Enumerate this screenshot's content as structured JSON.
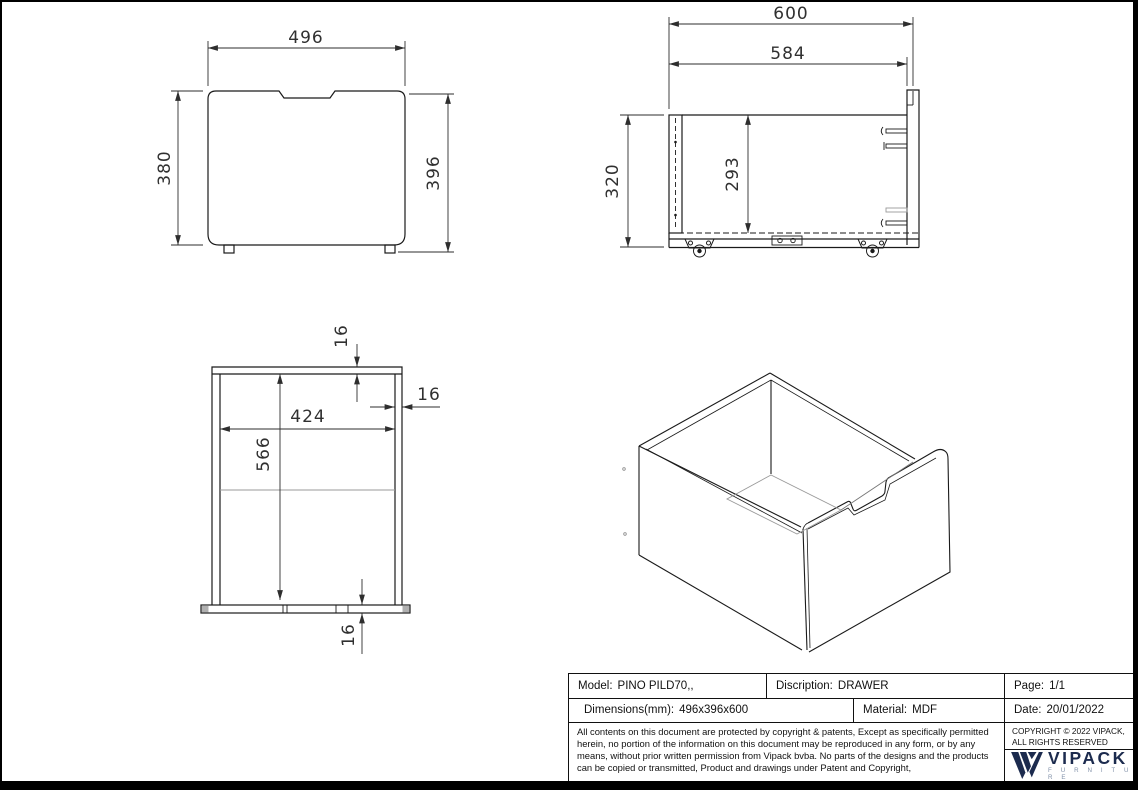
{
  "drawing": {
    "front_view": {
      "width": "496",
      "height_left": "380",
      "height_right": "396"
    },
    "side_view": {
      "depth_total": "600",
      "depth_inner": "584",
      "height": "320",
      "inner_height": "293"
    },
    "top_view": {
      "back_thickness": "16",
      "side_thickness": "16",
      "inner_width": "424",
      "inner_depth": "566",
      "front_thickness": "16"
    }
  },
  "title_block": {
    "model": {
      "label": "Model:",
      "value": "PINO PILD70,,"
    },
    "description": {
      "label": "Discription:",
      "value": "DRAWER"
    },
    "page": {
      "label": "Page:",
      "value": "1/1"
    },
    "dimensions": {
      "label": "Dimensions(mm):",
      "value": "496x396x600"
    },
    "material": {
      "label": "Material:",
      "value": "MDF"
    },
    "date": {
      "label": "Date:",
      "value": "20/01/2022"
    },
    "disclaimer": "All contents on this document are protected by copyright & patents, Except as specifically permitted herein, no portion of the information on this document may be reproduced in any form, or by any means, without prior written permission from Vipack bvba. No parts of the designs and the products can be copied or transmitted, Product and drawings under Patent and Copyright,",
    "copyright_line1": "COPYRIGHT  © 2022 VIPACK,",
    "copyright_line2": "ALL RIGHTS RESERVED",
    "brand": "VIPACK",
    "brand_sub": "F U R N I T U R E"
  },
  "colors": {
    "line": "#1a1a1a",
    "dim": "#2e2e2e",
    "gray": "#9a9a9a",
    "navy": "#1c2b4e",
    "brand_sub": "#8090a8"
  }
}
